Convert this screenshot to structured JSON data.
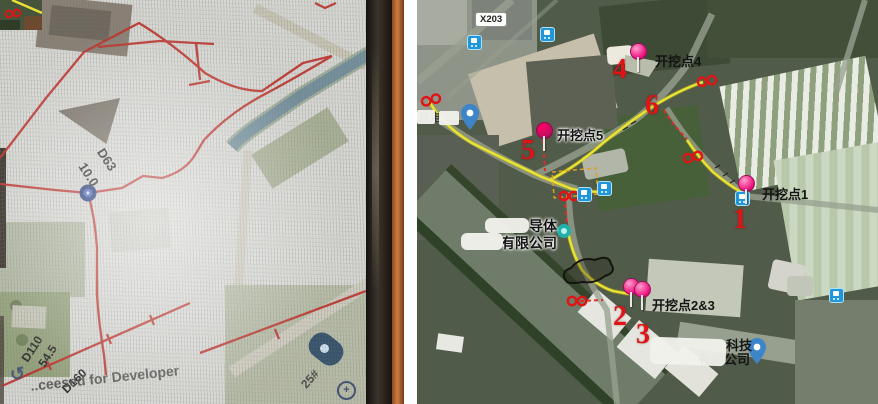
{
  "left_panel": {
    "description": "photo of a screen showing a red pipeline route map",
    "pipes": {
      "d63": "D63",
      "l63": "10.0",
      "d110": "D110",
      "l110": "54.5",
      "d160": "D160"
    },
    "watermark": "..ceesed for Developer",
    "block_no": "25#",
    "icons": {
      "refresh": "↺",
      "zoom_in": "+"
    },
    "inset_marker": "00"
  },
  "right_panel": {
    "road_badge": "X203",
    "endpoint_marker": "00",
    "points": [
      {
        "num": "1",
        "label": "开挖点1"
      },
      {
        "num": "2",
        "label": ""
      },
      {
        "num": "3",
        "label": "开挖点2&3"
      },
      {
        "num": "4",
        "label": "开挖点4"
      },
      {
        "num": "5",
        "label": "开挖点5"
      },
      {
        "num": "6",
        "label": ""
      }
    ],
    "companies": [
      {
        "name": "导体",
        "suffix": "有限公司"
      },
      {
        "name": "科技",
        "suffix": "有限公司"
      }
    ],
    "station": "存电",
    "colors": {
      "route": "#e8e435",
      "dashed": "#d83028",
      "pin": "#ee1480",
      "number": "#e01414"
    }
  }
}
